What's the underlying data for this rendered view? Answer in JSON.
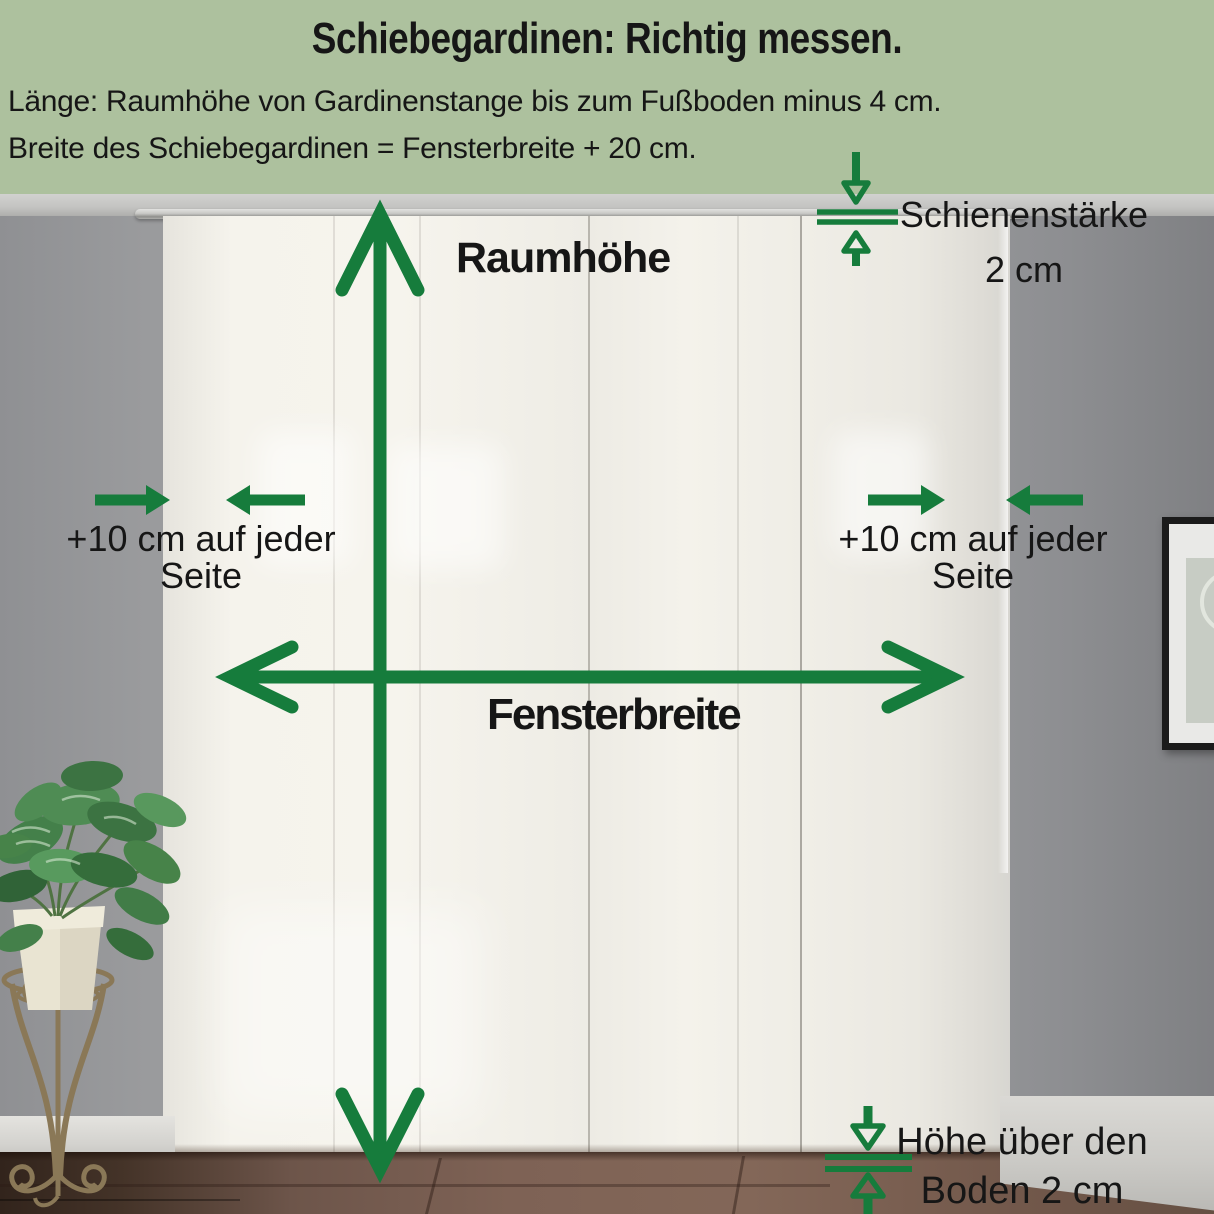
{
  "header": {
    "title": "Schiebegardinen: Richtig messen.",
    "instruction_length": "Länge: Raumhöhe von Gardinenstange bis zum Fußboden minus 4 cm.",
    "instruction_width": "Breite des Schiebegardinen = Fensterbreite + 20 cm."
  },
  "annotations": {
    "room_height": {
      "label": "Raumhöhe"
    },
    "window_width": {
      "label": "Fensterbreite"
    },
    "left_offset": {
      "line1": "+10 cm auf jeder",
      "line2": "Seite"
    },
    "right_offset": {
      "line1": "+10 cm auf jeder",
      "line2": "Seite"
    },
    "rail_thickness": {
      "line1": "Schienenstärke",
      "line2": "2 cm"
    },
    "floor_gap": {
      "line1": "Höhe über den",
      "line2": "Boden 2 cm"
    }
  },
  "colors": {
    "arrow_green": "#167c3c",
    "header_background": "#adc19e",
    "text_black": "#161616"
  }
}
